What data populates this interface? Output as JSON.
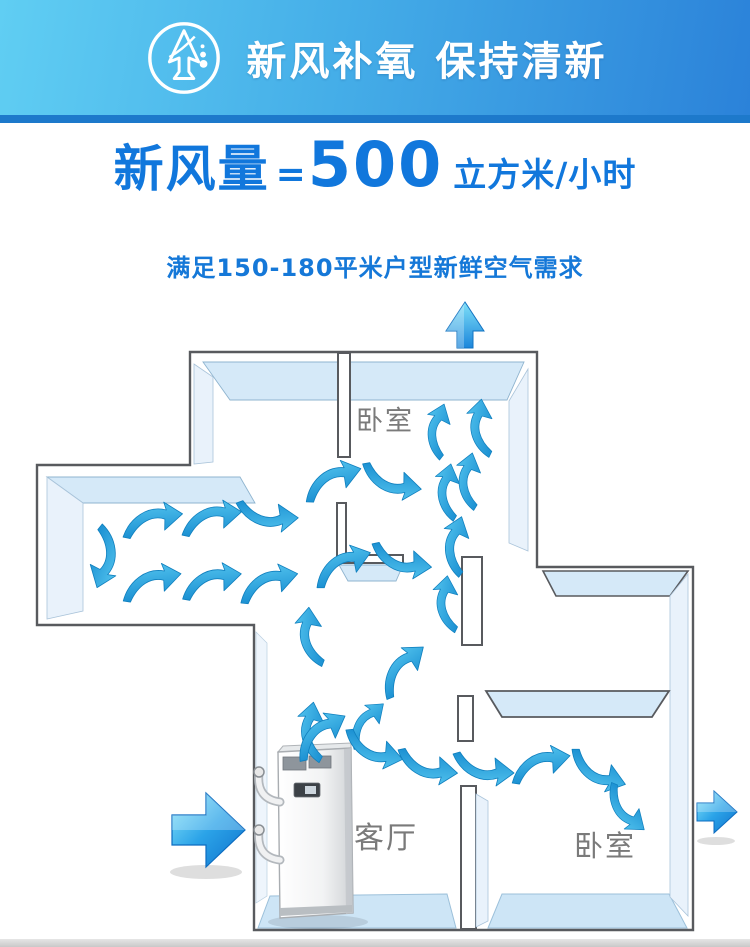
{
  "banner": {
    "title": "新风补氧 保持清新",
    "icon": "tree-arrow-icon",
    "gradient_left": "#60cef3",
    "gradient_right": "#2b82d9",
    "bottom_strip_color": "#1d79cb"
  },
  "headline": {
    "label": "新风量",
    "equals": "=",
    "value": "500",
    "unit": "立方米/小时",
    "color": "#1177dc"
  },
  "subline": {
    "text": "满足150-180平米户型新鲜空气需求",
    "color": "#1578d8"
  },
  "floorplan": {
    "rooms": {
      "bedroom_top": "卧室",
      "living_room": "客厅",
      "bedroom_right": "卧室"
    },
    "equipment": "fresh-air-ventilation-unit",
    "flow_arrows": {
      "intake": "left-intake-arrow",
      "exhaust_top": "top-exhaust-arrow",
      "exhaust_right": "right-exhaust-arrow",
      "airflow_swoosh_count": 28
    },
    "colors": {
      "wall_outline": "#585a5e",
      "wall_face": "#d5e9f8",
      "wall_face_pale": "#e9f2fb",
      "floor": "#cde5f6",
      "swoosh": "#2ba4e2"
    }
  }
}
